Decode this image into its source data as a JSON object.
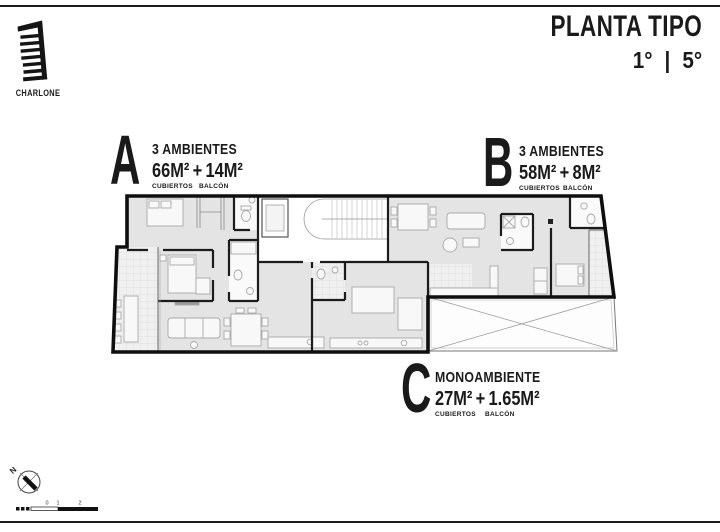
{
  "brand": {
    "name": "CHARLONE"
  },
  "title": {
    "main": "PLANTA TIPO",
    "floors": "1° | 5°"
  },
  "units": [
    {
      "letter": "A",
      "type": "3 AMBIENTES",
      "covered": "66M²",
      "plus": "+",
      "balcony": "14M²",
      "covered_label": "CUBIERTOS",
      "balcony_label": "BALCÓN"
    },
    {
      "letter": "B",
      "type": "3 AMBIENTES",
      "covered": "58M²",
      "plus": "+",
      "balcony": "8M²",
      "covered_label": "CUBIERTOS",
      "balcony_label": "BALCÓN"
    },
    {
      "letter": "C",
      "type": "MONOAMBIENTE",
      "covered": "27M²",
      "plus": "+",
      "balcony": "1.65M²",
      "covered_label": "CUBIERTOS",
      "balcony_label": "BALCÓN"
    }
  ],
  "compass": {
    "north_label": "N"
  },
  "scale_bar": {
    "ticks": [
      "0",
      "1",
      "2"
    ]
  },
  "colors": {
    "wall": "#111111",
    "room_fill": "#e4e4e4",
    "text": "#1a1a1a"
  }
}
